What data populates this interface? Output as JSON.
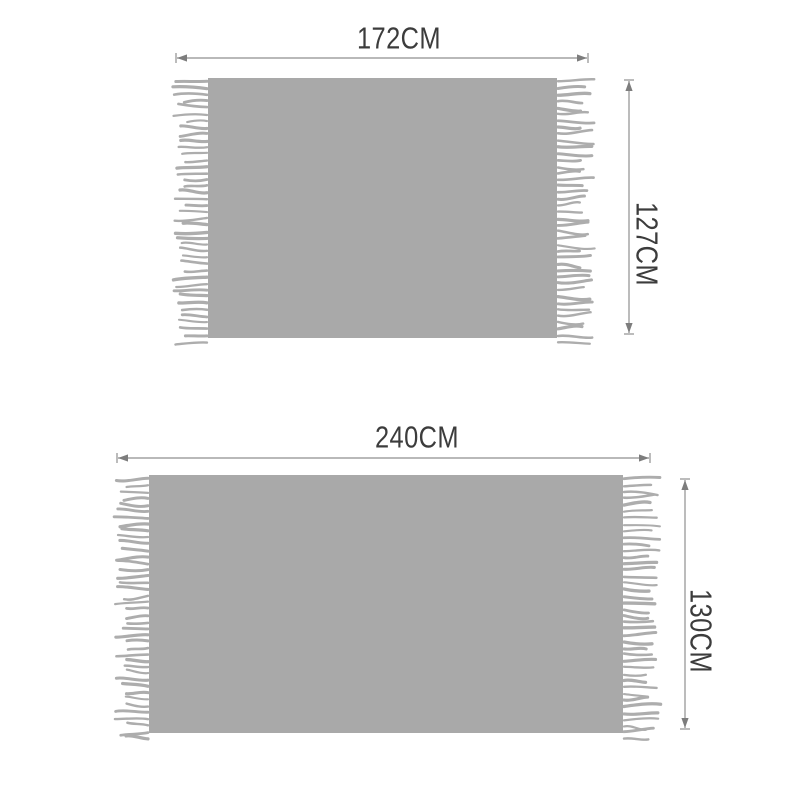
{
  "page": {
    "background_color": "#ffffff"
  },
  "diagram": {
    "type": "product-dimension-diagram",
    "items": [
      {
        "id": "top-blanket",
        "width_label": "172CM",
        "height_label": "127CM",
        "width_cm": 172,
        "height_cm": 127
      },
      {
        "id": "bottom-blanket",
        "width_label": "240CM",
        "height_label": "130CM",
        "width_cm": 240,
        "height_cm": 130
      }
    ],
    "colors": {
      "blanket_body": "#a9a9a9",
      "fringe": "#adadad",
      "dimension_line": "#8f8f8f",
      "arrow_head": "#7d7d7d",
      "label_text": "#3c3c3c"
    }
  }
}
